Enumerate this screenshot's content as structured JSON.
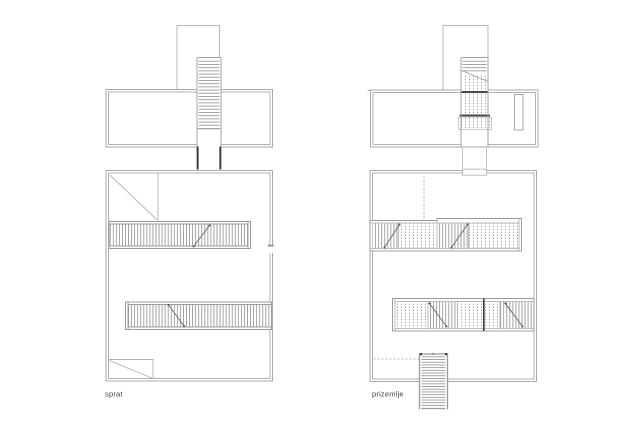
{
  "drawing": {
    "description_visible_text_only": true,
    "plans": [
      {
        "id": "sprat",
        "label": "sprat"
      },
      {
        "id": "prizemlje",
        "label": "prizemlje"
      }
    ]
  },
  "colors": {
    "background": "#ffffff",
    "wall_line": "#a9a9a9",
    "thin_line": "#b8b8b8",
    "tread_line": "#999999",
    "dot_texture": "#8f8f8f",
    "dark_accent": "#3a3a3a",
    "label_text": "#3f3f3f"
  }
}
